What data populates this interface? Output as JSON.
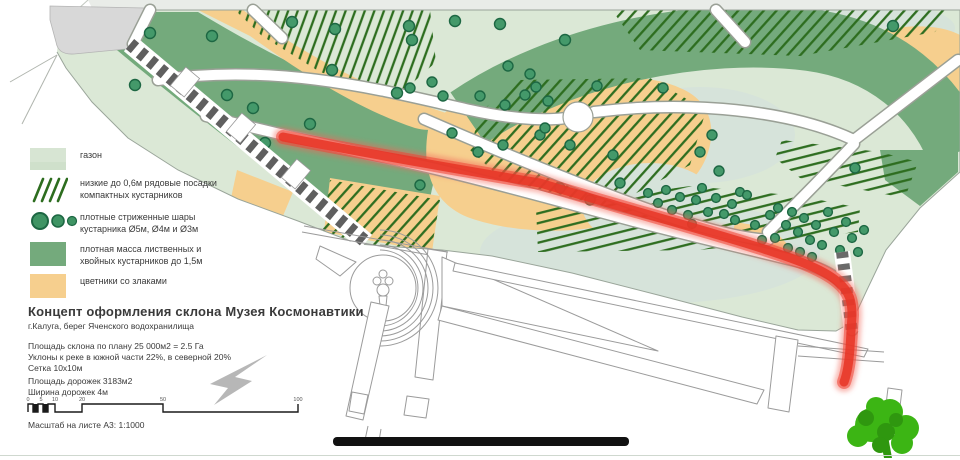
{
  "legend": {
    "items": [
      {
        "id": "lawn",
        "label": "газон"
      },
      {
        "id": "low-row-shrubs",
        "label": "низкие до 0,6м рядовые посадки\nкомпактных кустарников"
      },
      {
        "id": "trimmed-balls",
        "label": "плотные стриженные шары\nкустарника Ø5м, Ø4м и Ø3м"
      },
      {
        "id": "dense-mass",
        "label": "плотная масса лиственных и\nхвойных кустарников до 1,5м"
      },
      {
        "id": "flower-beds",
        "label": "цветники со злаками"
      }
    ]
  },
  "title_block": {
    "title": "Концепт оформления склона Музея Космонавтики",
    "subtitle": "г.Калуга, берег Яченского водохранилища",
    "notes": "Площадь склона по плану 25 000м2 = 2.5 Га\nУклоны к реке в южной части 22%, в северной 20%\nСетка 10х10м",
    "notes2": "Площадь дорожек 3183м2\nШирина дорожек 4м"
  },
  "scale_bar": {
    "ticks": [
      "0",
      "5",
      "10",
      "20",
      "50",
      "100"
    ],
    "caption": "Масштаб на листе А3: 1:1000"
  },
  "colors": {
    "lawn": "#dbe8d6",
    "lawn_alt": "#d6e3da",
    "dense_green": "#74aa7c",
    "flower_orange": "#f6cf8e",
    "hatch_green": "#2d6d1f",
    "shrub_fill": "#44996a",
    "shrub_stroke": "#1d6743",
    "route_red": "#e63526",
    "stair_gray": "#5f5f5f",
    "plot_gray": "#d8d8d8"
  }
}
